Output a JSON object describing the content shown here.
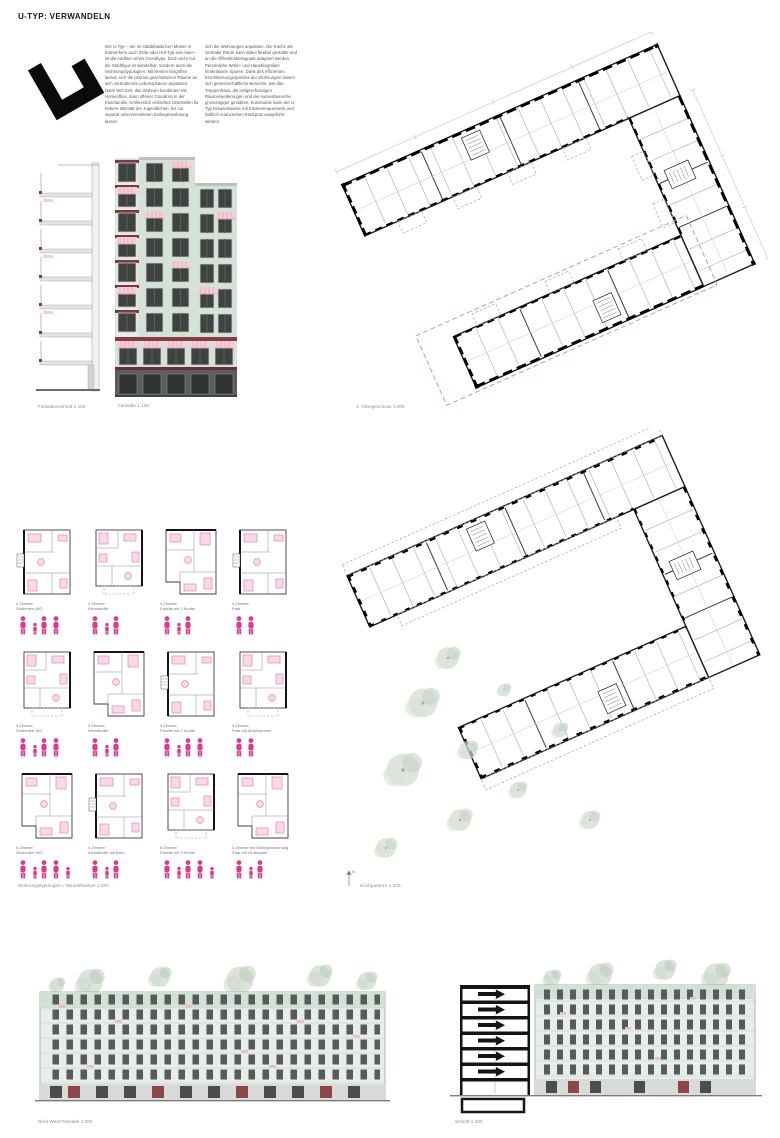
{
  "board": {
    "title": "U-TYP: VERWANDELN",
    "intro_col1": "Der U-Typ – der im städtebaulichen Muster in Extremform auch Zeile oder Hof-Typ sein kann – ist die Addition eines Grundtyps. Doch nicht nur die Stadtfigur ist wandelbar, sondern auch die Wohnungstypologien. Mit kleinen Eingriffen lassen sich die präzise geschnittenen Räume an sich verändernde Lebensphasen anpassen: Nach WG-Zeit, das Wohnen kombiniert mit Homeoffice, dann offener Grundriss in der Kleinfamilie, schliesslich einfaches Unterteilen für höhere Intimität der Jugendlichen, bis zur separat untervermieteten Einliegerwohnung lassen",
    "intro_col2": "sich die Wohnungen anpassen. Die Küche als zentraler Raum kann dabei flexibel gestaltet und an die Öffentlichkeitsgrade adaptiert werden. Persönliche Wohn- und Hausbiografien hinterlassen Spuren. Dank des effizienten Erschliessungssystems der Wohnungen lassen sich gemeinschaftliche Bereiche, wie das Treppenhaus, die erdgeschossigen Raumerweiterungen und die Aussenbereiche grosszügiger gestalten. Konstruktiv kann der U-Typ beispielsweise mit Einsteinmauerwerk und farblich nuanciertem Kratzputz ausgeführt werden."
  },
  "captions": {
    "fassadenschnitt": "Fassadenschnitt 1:100",
    "fassade": "Fassade 1:100",
    "obergeschoss": "1. Obergeschoss 1:200",
    "typologien": "Wohnungstypologien / Wandelbarkeit 1:200",
    "hochparterre": "Hochparterre 1:200",
    "nordwest": "Nord West Fassade 1:200",
    "schnitt": "Schnitt 1:200"
  },
  "icons": {
    "north_label": "N"
  },
  "colors": {
    "accent_pink": "#d63d8f",
    "furniture_pink": "#e487ae",
    "mint_facade": "#d3e3d7",
    "maroon_band": "#8a3d41",
    "window_dark": "#3e4341",
    "plan_pink_dash": "#dc90a7"
  },
  "typologies": {
    "units": [
      {
        "rooms": "4 Zimmer",
        "desc": "Studenten WG",
        "figures": 4
      },
      {
        "rooms": "3 Zimmer",
        "desc": "Kleinfamilie",
        "figures": 3
      },
      {
        "rooms": "4 Zimmer",
        "desc": "Familie mit 2 Kinder",
        "figures": 3
      },
      {
        "rooms": "4 Zimmer",
        "desc": "Paar",
        "figures": 2
      },
      {
        "rooms": "4 Zimmer",
        "desc": "Studenten WG",
        "figures": 4
      },
      {
        "rooms": "3 Zimmer",
        "desc": "Kleinfamilie",
        "figures": 3
      },
      {
        "rooms": "4 Zimmer",
        "desc": "Familie mit 2 Kinder",
        "figures": 4
      },
      {
        "rooms": "4 Zimmer",
        "desc": "Paar mit Musikzimmer",
        "figures": 2
      },
      {
        "rooms": "6 Zimmer",
        "desc": "Studenten WG",
        "figures": 5
      },
      {
        "rooms": "4 Zimmer",
        "desc": "Kleinfamilie mit Büro",
        "figures": 3
      },
      {
        "rooms": "5 Zimmer",
        "desc": "Familie mit 3 Kinder",
        "figures": 5
      },
      {
        "rooms": "3 Zimmer mit Einliegerwohnung",
        "desc": "Paar mit Grossvater",
        "figures": 3
      }
    ]
  }
}
